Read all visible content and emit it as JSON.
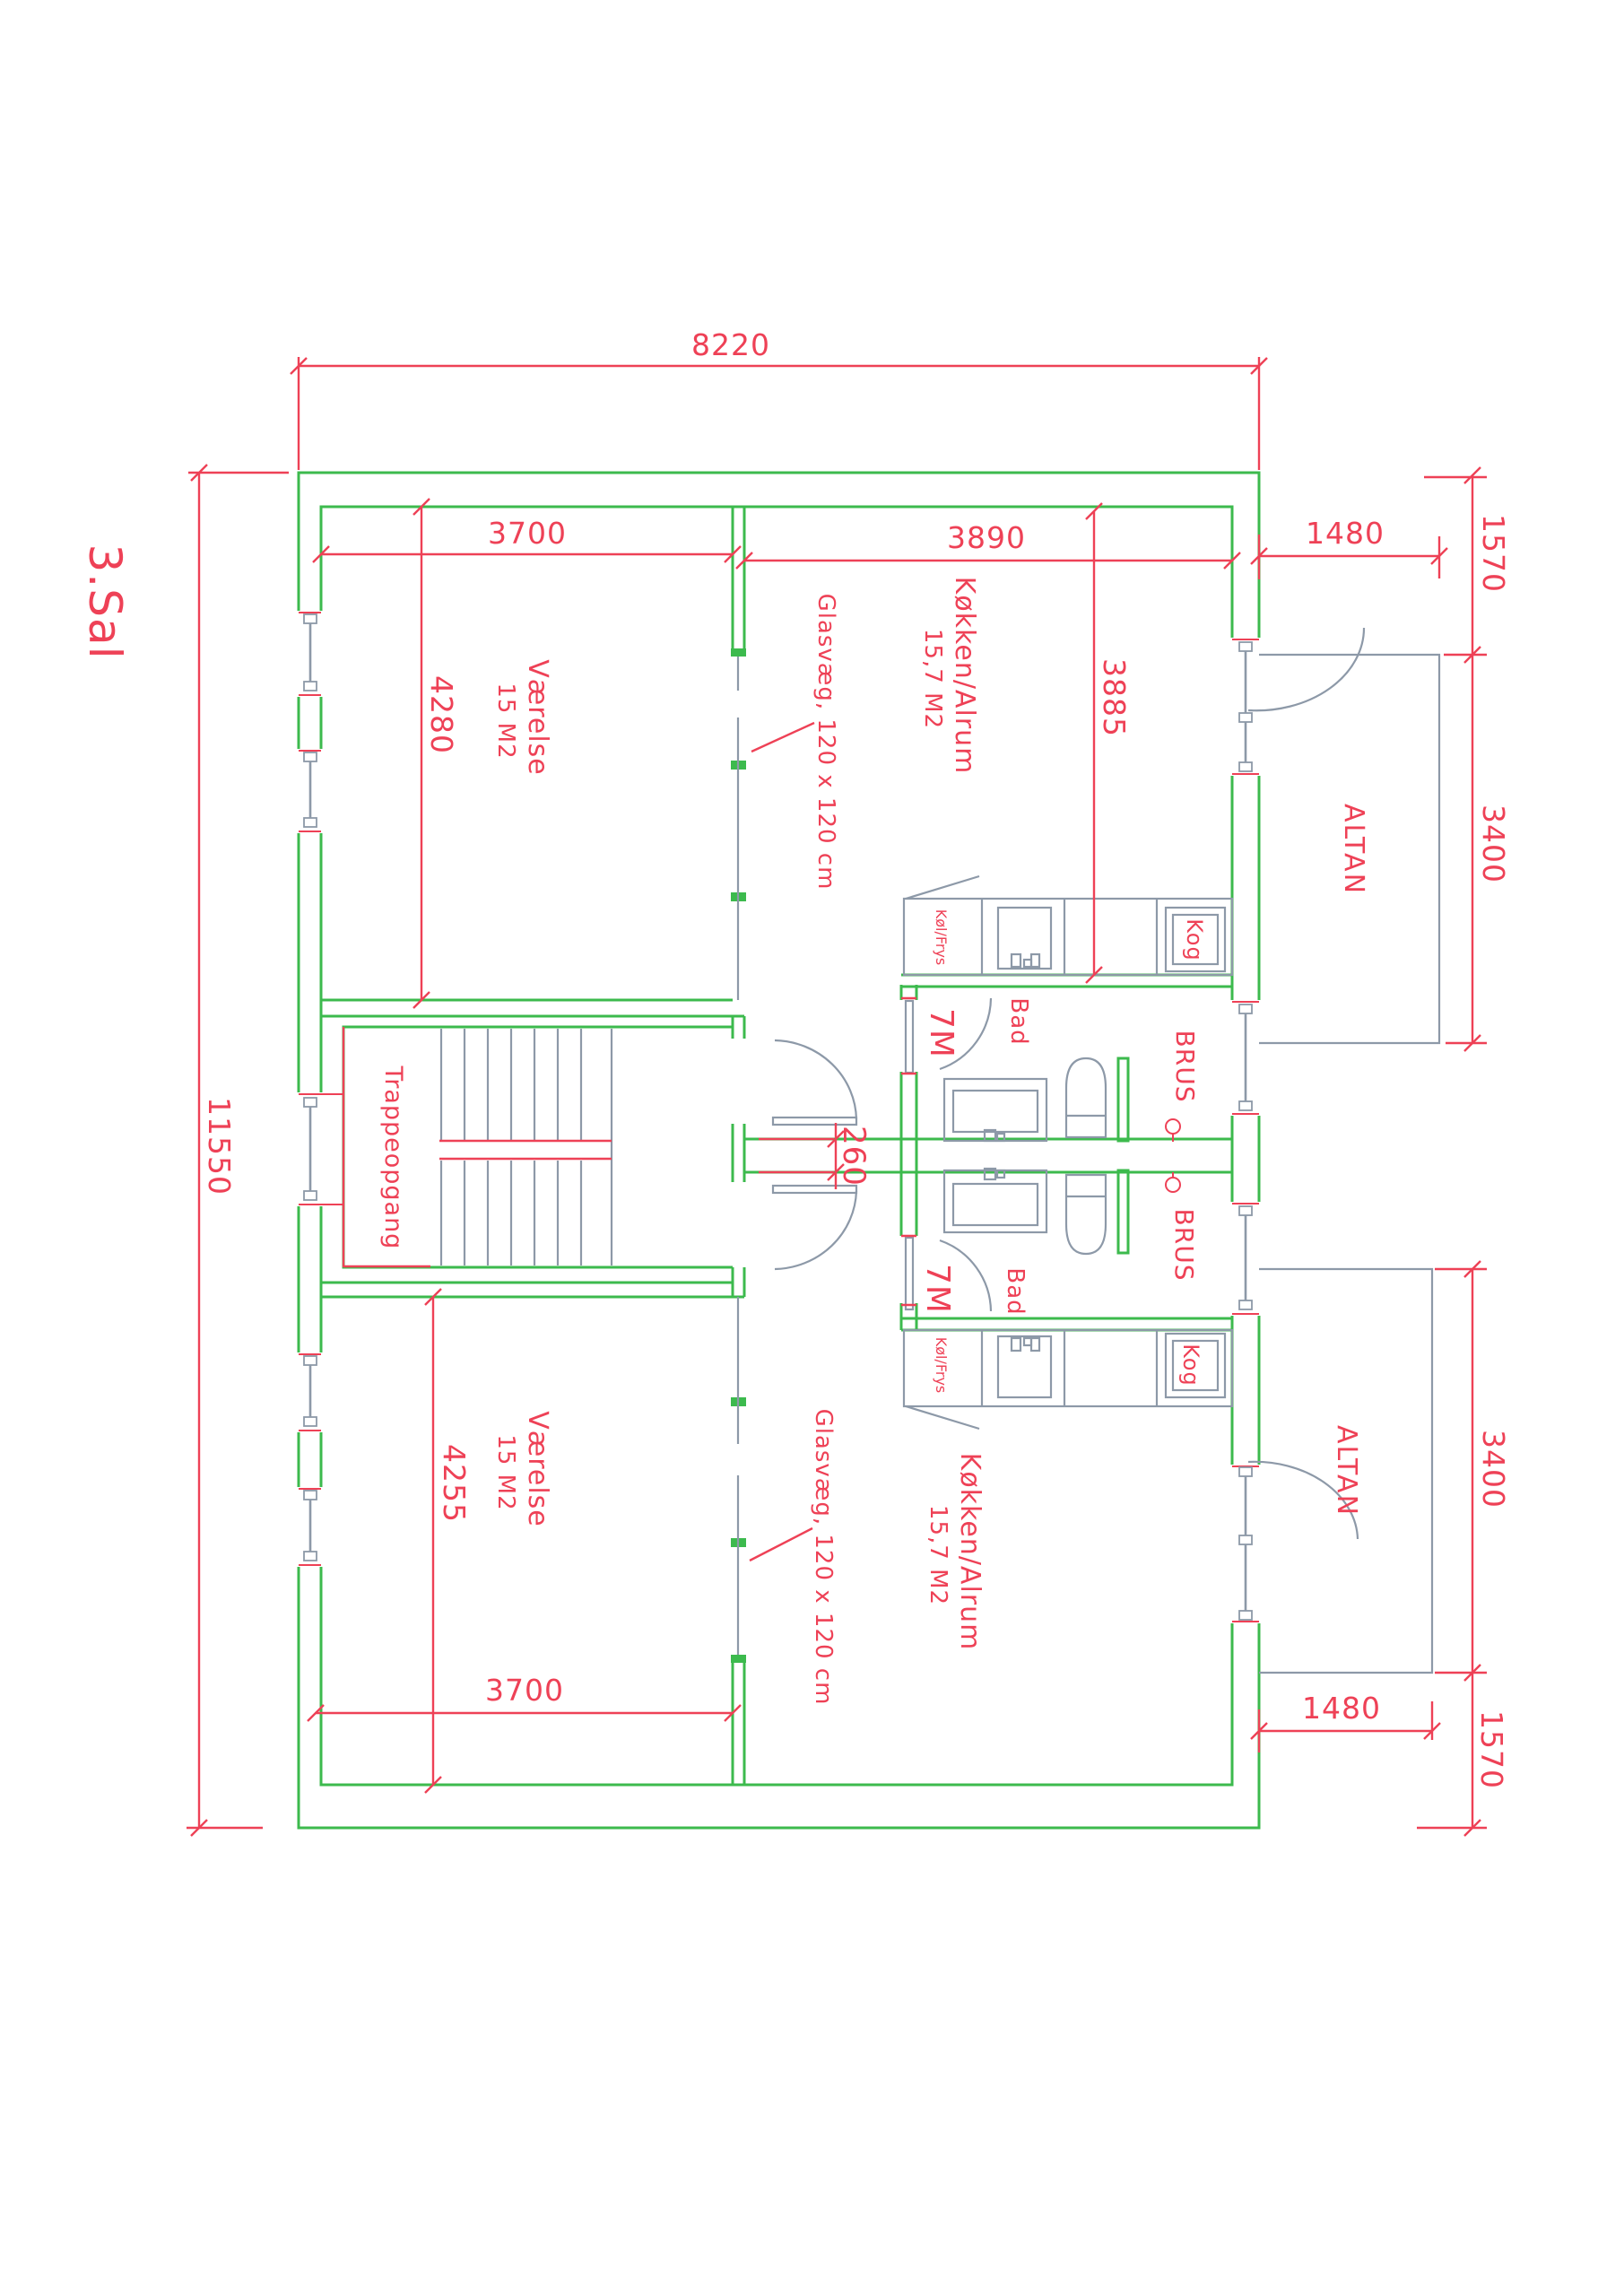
{
  "title": "3.Sal",
  "colors": {
    "wall_green": "#3cba4d",
    "annotation_red": "#ee4156",
    "fixture_gray": "#8d99a8",
    "background": "#ffffff"
  },
  "labels": {
    "floor": "3.Sal",
    "room": "Værelse",
    "room_area": "15 M2",
    "kitchen": "Køkken/Alrum",
    "kitchen_area": "15,7 M2",
    "stairwell": "Trappeopgang",
    "bath": "Bad",
    "bath_area": "7M",
    "shower": "BRUS",
    "cooktop": "Kog",
    "fridge_freezer": "Køl/Frys",
    "balcony": "ALTAN",
    "glass_wall": "Glasvæg, 120 x 120 cm"
  },
  "dimensions": {
    "overall_width": "8220",
    "overall_depth": "11550",
    "room_top_width": "3700",
    "kitchen_top_width": "3890",
    "room_top_depth": "4280",
    "kitchen_top_depth": "3885",
    "balcony_top_setback": "1570",
    "balcony_top_width": "1480",
    "balcony_top_depth": "3400",
    "party_wall": "260",
    "room_bottom_depth": "4255",
    "room_bottom_width": "3700",
    "balcony_bottom_width": "1480",
    "balcony_bottom_depth": "3400",
    "balcony_bottom_setback": "1570"
  }
}
